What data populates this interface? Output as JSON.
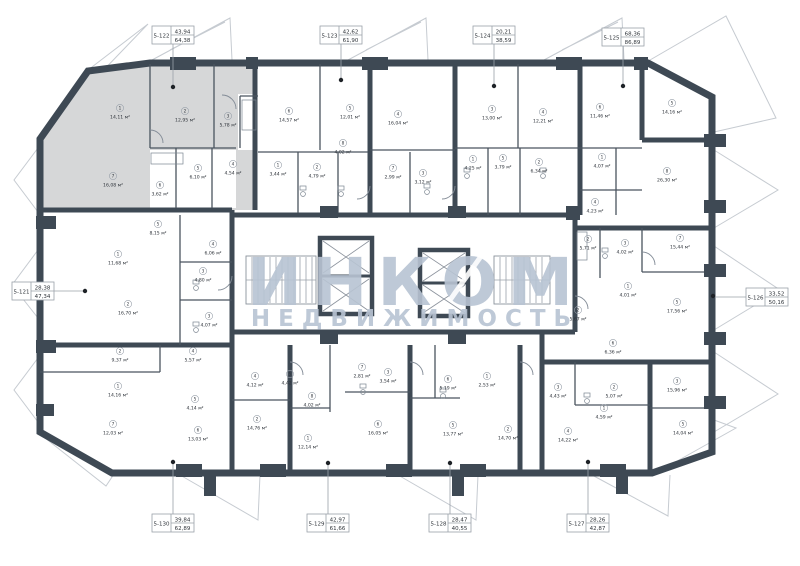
{
  "watermark": {
    "line1": "ИНКОМ",
    "line2": "НЕДВИЖИМОСТЬ"
  },
  "colors": {
    "wall": "#3e4954",
    "unit_highlight": "#d6d7d8",
    "watermark": "#b8c4d3"
  },
  "units": [
    {
      "id": "5-121",
      "top": "28,38",
      "bottom": "47,34"
    },
    {
      "id": "5-122",
      "top": "43,94",
      "bottom": "64,38"
    },
    {
      "id": "5-123",
      "top": "42,62",
      "bottom": "61,90"
    },
    {
      "id": "5-124",
      "top": "20,21",
      "bottom": "38,59"
    },
    {
      "id": "5-125",
      "top": "68,36",
      "bottom": "86,89"
    },
    {
      "id": "5-126",
      "top": "33,52",
      "bottom": "50,16"
    },
    {
      "id": "5-127",
      "top": "28,26",
      "bottom": "42,87"
    },
    {
      "id": "5-128",
      "top": "28,47",
      "bottom": "40,55"
    },
    {
      "id": "5-129",
      "top": "42,97",
      "bottom": "61,66"
    },
    {
      "id": "5-130",
      "top": "39,84",
      "bottom": "62,89"
    }
  ],
  "rooms": [
    {
      "n": "1",
      "a": "14,11 м²"
    },
    {
      "n": "2",
      "a": "12,95 м²"
    },
    {
      "n": "3",
      "a": "5,78 м²"
    },
    {
      "n": "7",
      "a": "16,08 м²"
    },
    {
      "n": "6",
      "a": "3,62 м²"
    },
    {
      "n": "5",
      "a": "6,10 м²"
    },
    {
      "n": "4",
      "a": "4,54 м²"
    },
    {
      "n": "6",
      "a": "14,57 м²"
    },
    {
      "n": "5",
      "a": "12,01 м²"
    },
    {
      "n": "4",
      "a": "16,04 м²"
    },
    {
      "n": "8",
      "a": "4,02 м²"
    },
    {
      "n": "1",
      "a": "3,44 м²"
    },
    {
      "n": "2",
      "a": "4,79 м²"
    },
    {
      "n": "7",
      "a": "2,99 м²"
    },
    {
      "n": "3",
      "a": "3,12 м²"
    },
    {
      "n": "3",
      "a": "13,00 м²"
    },
    {
      "n": "4",
      "a": "12,21 м²"
    },
    {
      "n": "6",
      "a": "11,46 м²"
    },
    {
      "n": "1",
      "a": "4,25 м²"
    },
    {
      "n": "5",
      "a": "3,79 м²"
    },
    {
      "n": "2",
      "a": "6,34 м²"
    },
    {
      "n": "1",
      "a": "4,07 м²"
    },
    {
      "n": "4",
      "a": "4,23 м²"
    },
    {
      "n": "5",
      "a": "14,16 м²"
    },
    {
      "n": "8",
      "a": "26,30 м²"
    },
    {
      "n": "2",
      "a": "5,71 м²"
    },
    {
      "n": "3",
      "a": "4,02 м²"
    },
    {
      "n": "7",
      "a": "15,44 м²"
    },
    {
      "n": "1",
      "a": "4,01 м²"
    },
    {
      "n": "5",
      "a": "17,56 м²"
    },
    {
      "n": "2",
      "a": "5,67 м²"
    },
    {
      "n": "6",
      "a": "6,36 м²"
    },
    {
      "n": "5",
      "a": "8,15 м²"
    },
    {
      "n": "1",
      "a": "11,68 м²"
    },
    {
      "n": "4",
      "a": "6,06 м²"
    },
    {
      "n": "3",
      "a": "4,80 м²"
    },
    {
      "n": "2",
      "a": "16,70 м²"
    },
    {
      "n": "3",
      "a": "4,07 м²"
    },
    {
      "n": "2",
      "a": "9,37 м²"
    },
    {
      "n": "4",
      "a": "5,57 м²"
    },
    {
      "n": "1",
      "a": "14,16 м²"
    },
    {
      "n": "5",
      "a": "4,14 м²"
    },
    {
      "n": "4",
      "a": "4,12 м²"
    },
    {
      "n": "7",
      "a": "12,03 м²"
    },
    {
      "n": "6",
      "a": "13,03 м²"
    },
    {
      "n": "2",
      "a": "14,76 м²"
    },
    {
      "n": "5",
      "a": "4,42 м²"
    },
    {
      "n": "7",
      "a": "2,81 м²"
    },
    {
      "n": "3",
      "a": "3,54 м²"
    },
    {
      "n": "6",
      "a": "5,19 м²"
    },
    {
      "n": "1",
      "a": "2,53 м²"
    },
    {
      "n": "8",
      "a": "4,02 м²"
    },
    {
      "n": "1",
      "a": "12,14 м²"
    },
    {
      "n": "6",
      "a": "16,05 м²"
    },
    {
      "n": "5",
      "a": "13,77 м²"
    },
    {
      "n": "2",
      "a": "14,70 м²"
    },
    {
      "n": "3",
      "a": "4,43 м²"
    },
    {
      "n": "2",
      "a": "5,07 м²"
    },
    {
      "n": "1",
      "a": "4,59 м²"
    },
    {
      "n": "3",
      "a": "15,96 м²"
    },
    {
      "n": "5",
      "a": "14,04 м²"
    },
    {
      "n": "4",
      "a": "14,22 м²"
    }
  ]
}
